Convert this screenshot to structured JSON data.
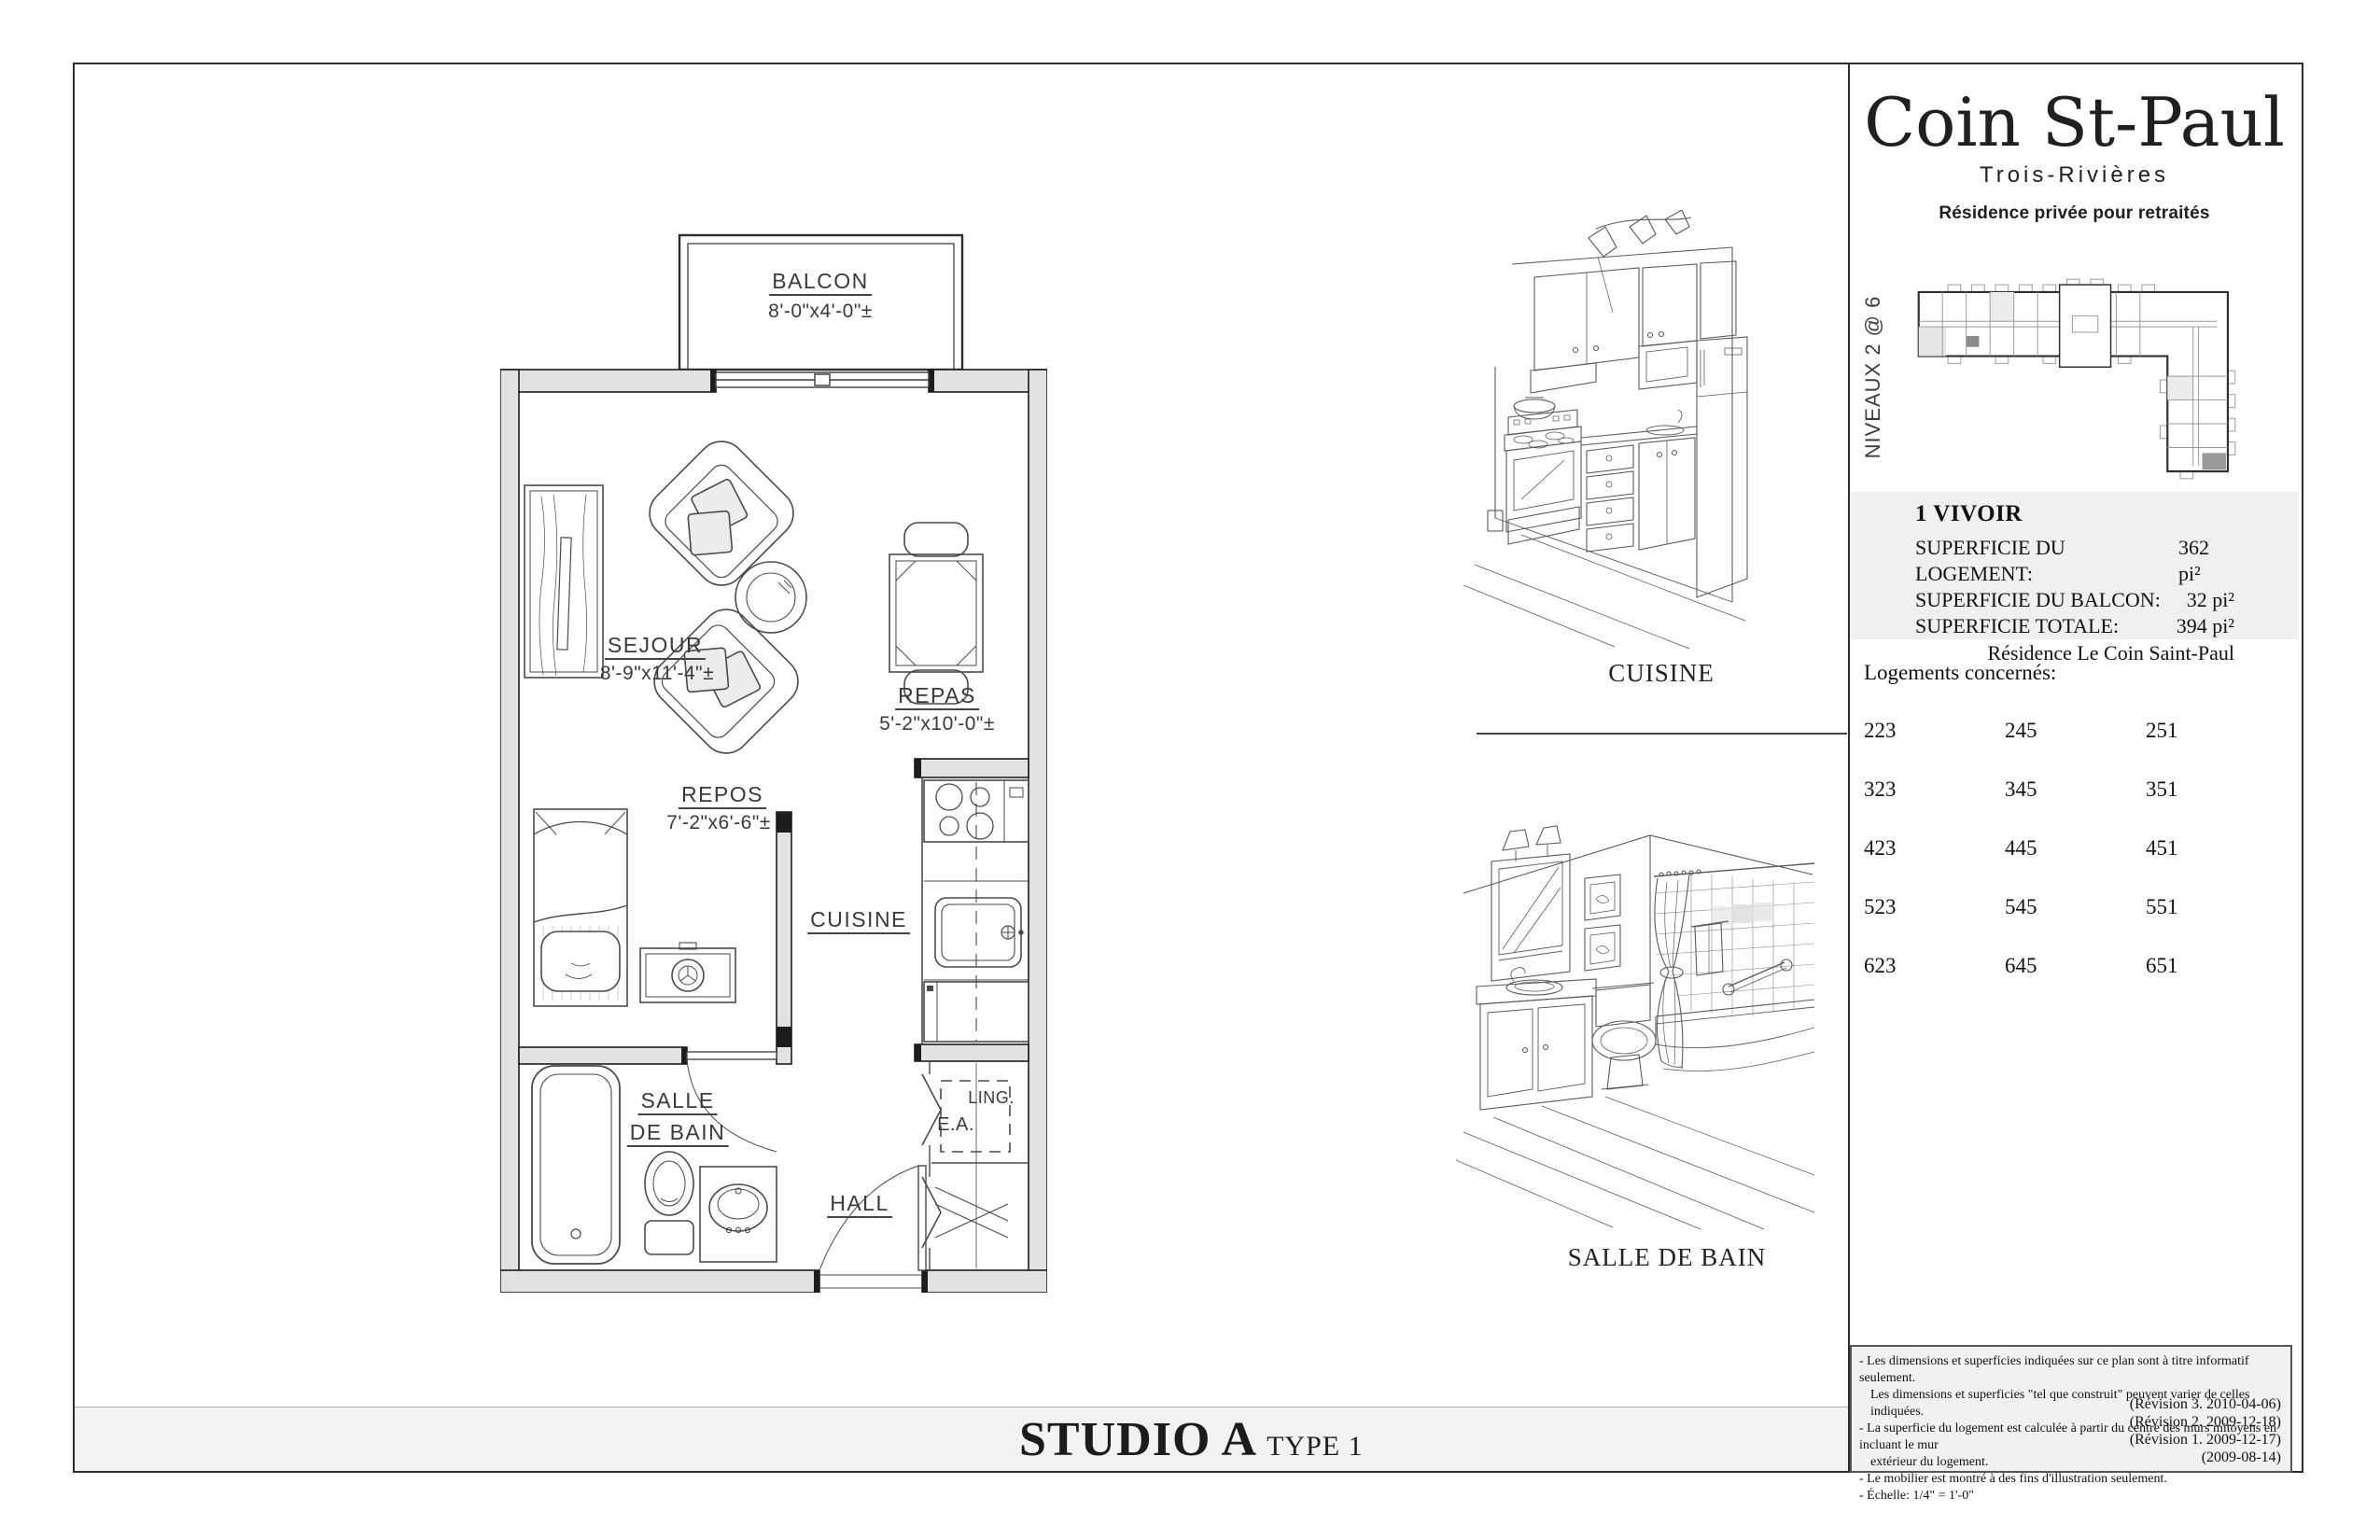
{
  "logo": {
    "name": "Coin St-Paul",
    "city": "Trois-Rivières",
    "tagline": "Résidence privée pour retraités"
  },
  "key_plan": {
    "label": "NIVEAUX 2 @ 6"
  },
  "unit_info": {
    "title": "1 VIVOIR",
    "rows": [
      {
        "label": "SUPERFICIE DU LOGEMENT:",
        "value": "362 pi²"
      },
      {
        "label": "SUPERFICIE DU BALCON:",
        "value": "32 pi²"
      },
      {
        "label": "SUPERFICIE TOTALE:",
        "value": "394 pi²"
      }
    ],
    "footer": "Résidence Le Coin Saint-Paul"
  },
  "units": {
    "title": "Logements concernés:",
    "rows": [
      [
        "223",
        "245",
        "251"
      ],
      [
        "323",
        "345",
        "351"
      ],
      [
        "423",
        "445",
        "451"
      ],
      [
        "523",
        "545",
        "551"
      ],
      [
        "623",
        "645",
        "651"
      ]
    ]
  },
  "notes": {
    "lines": [
      "- Les dimensions et superficies indiquées sur ce plan sont à titre informatif seulement.",
      "Les dimensions et superficies \"tel que construit\" peuvent varier de celles indiquées.",
      "- La superficie  du logement est calculée à partir du centre des murs mitoyens en incluant le mur",
      "extérieur du logement.",
      "- Le mobilier est montré à des fins d'illustration seulement.",
      "- Échelle: 1/4\" = 1'-0\""
    ],
    "revisions": [
      "(Révision 3. 2010-04-06)",
      "(Révision 2. 2009-12-18)",
      "(Révision 1. 2009-12-17)",
      "(2009-08-14)"
    ]
  },
  "plan": {
    "balcon": {
      "name": "BALCON",
      "dims": "8'-0\"x4'-0\"±"
    },
    "sejour": {
      "name": "SEJOUR",
      "dims": "8'-9\"x11'-4\"±"
    },
    "repas": {
      "name": "REPAS",
      "dims": "5'-2\"x10'-0\"±"
    },
    "repos": {
      "name": "REPOS",
      "dims": "7'-2\"x6'-6\"±"
    },
    "cuisine": {
      "name": "CUISINE"
    },
    "salle_de_bain": {
      "line1": "SALLE",
      "line2": "DE BAIN"
    },
    "hall": {
      "name": "HALL"
    },
    "ling": {
      "name": "LING."
    },
    "ea": {
      "name": "E.A."
    }
  },
  "sketches": {
    "kitchen_caption": "CUISINE",
    "bathroom_caption": "SALLE DE BAIN"
  },
  "title": {
    "main": "STUDIO A",
    "sub": "TYPE 1"
  }
}
